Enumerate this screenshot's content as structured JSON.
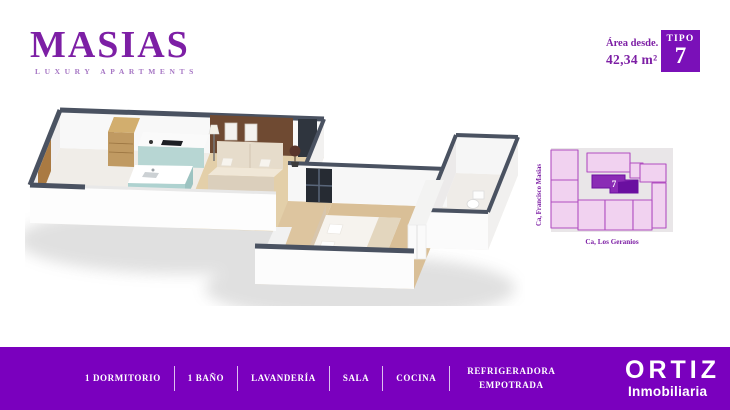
{
  "brand": {
    "name": "MASIAS",
    "tagline": "LUXURY APARTMENTS"
  },
  "unit": {
    "area_label": "Área desde.",
    "area_value": "42,34 m²",
    "badge_label": "TIPO",
    "badge_number": "7"
  },
  "site_map": {
    "street_left": "Ca, Francisco Masias",
    "street_bottom": "Ca, Los Geranios",
    "highlighted_unit": "7"
  },
  "footer": {
    "features": [
      "1 DORMITORIO",
      "1 BAÑO",
      "LAVANDERÍA",
      "SALA",
      "COCINA",
      "REFRIGERADORA EMPOTRADA"
    ],
    "agency_name": "ORTIZ",
    "agency_subtitle": "Inmobiliaria"
  },
  "colors": {
    "brand_purple": "#7d1fa5",
    "brand_purple_light": "#a676c4",
    "footer_purple": "#7a00be",
    "badge_purple": "#7a10b8",
    "wall_top_slate": "#4a5261",
    "map_unit_fill": "#f1d2f0",
    "map_unit_stroke": "#b14fc0",
    "map_highlight_dark": "#6a0fa0",
    "map_highlight": "#8a2bb5"
  }
}
